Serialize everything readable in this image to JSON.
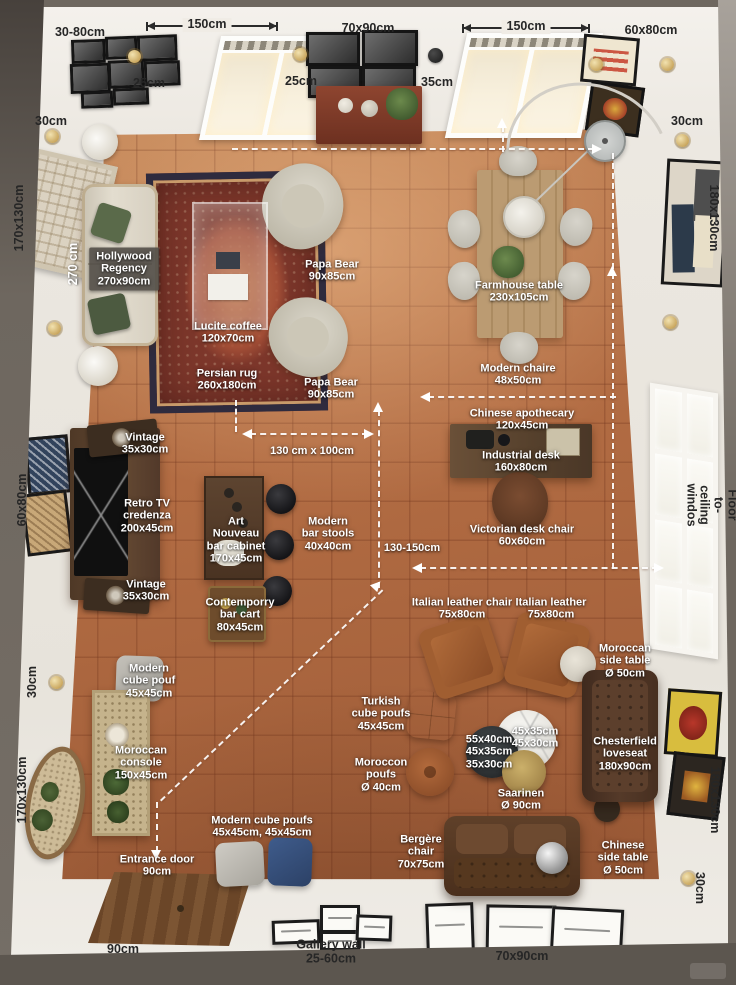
{
  "meta": {
    "description": "Top-down 3D rendered floor plan of a mid-century living room annotated with furniture names and dimensions"
  },
  "palette": {
    "floor_terracotta": "#b26c43",
    "wall_white": "#ece8e1",
    "surround_mat": "#6e675f",
    "label_light": "#ffffff",
    "label_dark": "#262626",
    "dash_line": "#ffffff"
  },
  "labels": {
    "top": {
      "gallery": "30-80cm",
      "win1": "150cm",
      "sconce1": "25cm",
      "photos": "70x90cm",
      "sconce2": "25cm",
      "sconce3": "35cm",
      "win2": "150cm",
      "posters": "60x80cm"
    },
    "left": {
      "sconce1": "30cm",
      "tapestry": "170x130cm",
      "sofa_length": "270 cm",
      "art": "60x80cm",
      "sconce2": "30cm",
      "mirror": "170x130cm"
    },
    "right": {
      "sconce1": "30cm",
      "art": "180x130cm",
      "window": "Floor to-ceiling windos",
      "posters": "180x130cm",
      "sconce2": "30cm"
    },
    "bottom": {
      "door": "90cm",
      "gallery": "Gallery wall\n25-60cm",
      "frames": "70x90cm"
    },
    "furniture": {
      "hollywood": "Hollywood\nRegency\n270x90cm",
      "papa1": "Papa Bear\n90x85cm",
      "lucite": "Lucite coffee\n120x70cm",
      "persian": "Persian rug\n260x180cm",
      "papa2": "Papa Bear\n90x85cm",
      "farmhouse": "Farmhouse table\n230x105cm",
      "chair_modern": "Modern chaire\n48x50cm",
      "apothecary": "Chinese apothecary\n120x45cm",
      "industrial": "Industrial desk\n160x80cm",
      "victorian": "Victorian desk chair\n60x60cm",
      "vintage1": "Vintage\n35x30cm",
      "retro": "Retro TV\ncredenza\n200x45cm",
      "artnouveau": "Art\nNouveau\nbar cabinet\n170x45cm",
      "stools": "Modern\nbar stools\n40x40cm",
      "vintage2": "Vintage\n35x30cm",
      "barcart": "Contemporry\nbar cart\n80x45cm",
      "italian1": "Italian leather chair\n75x80cm",
      "italian2": "Italian leather\n75x80cm",
      "moroccan_side": "Moroccan\nside table\nØ 50cm",
      "cube_pouf": "Modern\ncube pouf\n45x45cm",
      "turkish": "Turkish\ncube poufs\n45x45cm",
      "nesting1": "55x40cm\n45x35cm\n35x30cm",
      "nesting2": "45x35cm\n45x30cm",
      "chesterfield": "Chesterfield\nloveseat\n180x90cm",
      "console": "Moroccan\nconsole\n150x45cm",
      "moroccon_poufs": "Moroccon\npoufs\nØ 40cm",
      "saarinen": "Saarinen\nØ 90cm",
      "cube_poufs2": "Modern cube poufs\n45x45cm, 45x45cm",
      "bergere": "Bergère\nchair\n70x75cm",
      "entrance": "Entrance door\n90cm",
      "chinese_side": "Chinese\nside table\nØ 50cm"
    },
    "measures": {
      "m130x100": "130 cm x 100cm",
      "m130150": "130-150cm"
    }
  }
}
